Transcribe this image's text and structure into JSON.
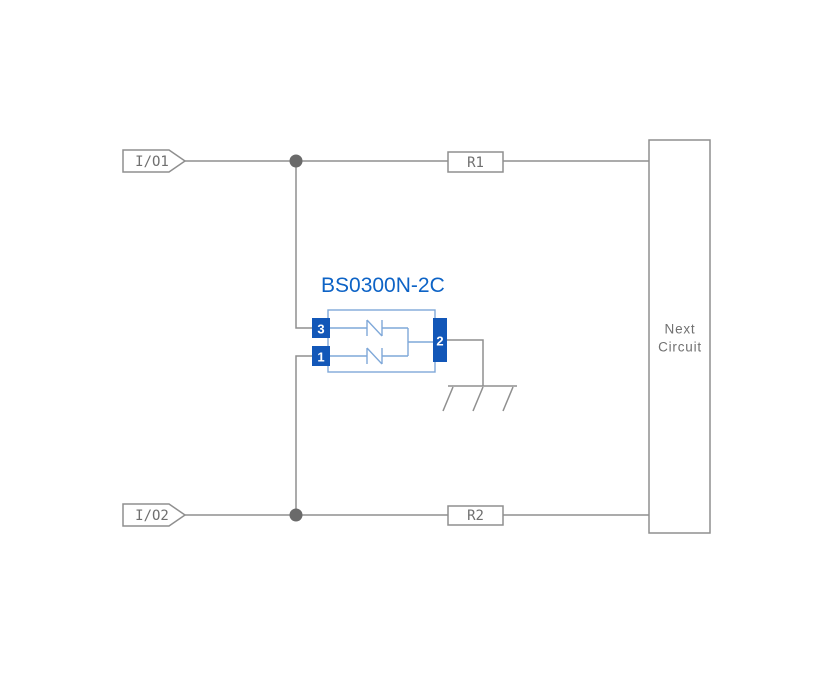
{
  "colors": {
    "background": "#ffffff",
    "wire": "#8f8f8f",
    "label": "#6f6f6f",
    "junction": "#6a6a6a",
    "pin_blue": "#1257b8",
    "component_outline": "#7fa8d9",
    "title_blue": "#0d63c6"
  },
  "component": {
    "title": "BS0300N-2C",
    "pins": [
      {
        "number": "3"
      },
      {
        "number": "1"
      },
      {
        "number": "2"
      }
    ]
  },
  "ports": [
    {
      "label": "I/O1"
    },
    {
      "label": "I/O2"
    }
  ],
  "resistors": [
    {
      "label": "R1"
    },
    {
      "label": "R2"
    }
  ],
  "next_circuit": {
    "line1": "Next",
    "line2": "Circuit"
  }
}
